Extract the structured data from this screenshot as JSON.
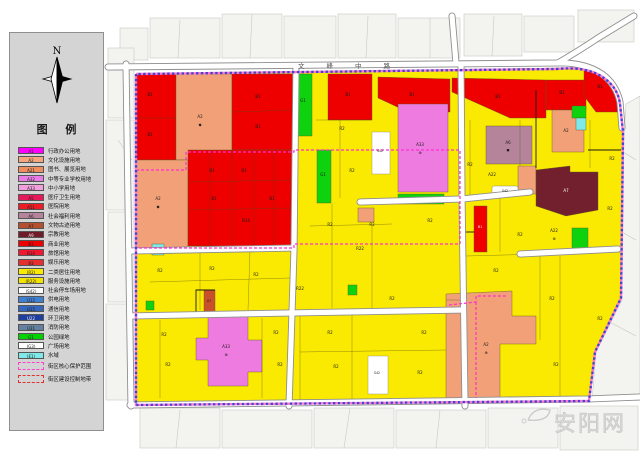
{
  "compass": {
    "label": "N"
  },
  "legend": {
    "title": "图 例",
    "items": [
      {
        "code": "A1",
        "label": "行政办公用地",
        "color": "#FF00FF"
      },
      {
        "code": "A2",
        "label": "文化设施用地",
        "color": "#F4A77C"
      },
      {
        "code": "A21",
        "label": "图书、展览用地",
        "color": "#F08D5E"
      },
      {
        "code": "A32",
        "label": "中等专业学校用地",
        "color": "#E87CE4"
      },
      {
        "code": "A33",
        "label": "中小学用地",
        "color": "#F2A0DC"
      },
      {
        "code": "A5",
        "label": "医疗卫生用地",
        "color": "#E6195A"
      },
      {
        "code": "A51",
        "label": "医院用地",
        "color": "#ED1C24"
      },
      {
        "code": "A6",
        "label": "社会福利用地",
        "color": "#B5849B"
      },
      {
        "code": "A7",
        "label": "文物古迹用地",
        "color": "#B4502F"
      },
      {
        "code": "A9",
        "label": "宗教用地",
        "color": "#701C28",
        "text": "#f0f0f0"
      },
      {
        "code": "B1",
        "label": "商业用地",
        "color": "#EE0000"
      },
      {
        "code": "B14",
        "label": "旅馆用地",
        "color": "#F01830"
      },
      {
        "code": "B3",
        "label": "娱乐用地",
        "color": "#E62E2E"
      },
      {
        "code": "(R2)",
        "label": "二类居住用地",
        "color": "#FAE900"
      },
      {
        "code": "(R22)",
        "label": "服务设施用地",
        "color": "#F2E300"
      },
      {
        "code": "(S42)",
        "label": "社会停车场用地",
        "color": "#FFFFFF"
      },
      {
        "code": "U12",
        "label": "供电用地",
        "color": "#3F7FD0"
      },
      {
        "code": "U15",
        "label": "通信用地",
        "color": "#3566BE"
      },
      {
        "code": "U22",
        "label": "环卫用地",
        "color": "#1F3F9E",
        "text": "#f0f0f0"
      },
      {
        "code": "U31",
        "label": "消防用地",
        "color": "#64819F"
      },
      {
        "code": "G1",
        "label": "公园绿地",
        "color": "#00D200"
      },
      {
        "code": "(G3)",
        "label": "广场用地",
        "color": "#FFFFFF"
      },
      {
        "code": "(E1)",
        "label": "水域",
        "color": "#7FE9EA"
      }
    ],
    "boundary_items": [
      {
        "label": "街区核心保护范围",
        "color": "#FF3FD0"
      },
      {
        "label": "街区建设控制地带",
        "color": "#E03030"
      }
    ]
  },
  "map": {
    "road_name": "文峰中路",
    "watermark": "安阳网",
    "colors": {
      "residential_yellow": "#FAE900",
      "commercial_red": "#EE0000",
      "cultural_salmon": "#F2A077",
      "school_pink": "#EE7BDF",
      "welfare_mauve": "#B5849B",
      "relics_maroon": "#72202E",
      "park_green": "#0FD20F",
      "water_cyan": "#7FE9EA",
      "parking_white": "#FFFFFF",
      "boundary_blue": "#4A3FD4",
      "boundary_pink": "#FF77C8",
      "core_pink": "#FF2FD0"
    },
    "labels": [
      {
        "t": "B1",
        "x": 150,
        "y": 96
      },
      {
        "t": "B1",
        "x": 150,
        "y": 136
      },
      {
        "t": "A2",
        "x": 200,
        "y": 118
      },
      {
        "t": "◆",
        "x": 200,
        "y": 126
      },
      {
        "t": "B1",
        "x": 258,
        "y": 98
      },
      {
        "t": "B1",
        "x": 258,
        "y": 128
      },
      {
        "t": "A2",
        "x": 158,
        "y": 200
      },
      {
        "t": "◆",
        "x": 158,
        "y": 208
      },
      {
        "t": "B1",
        "x": 212,
        "y": 172
      },
      {
        "t": "B1",
        "x": 244,
        "y": 172
      },
      {
        "t": "B1",
        "x": 214,
        "y": 200
      },
      {
        "t": "B14",
        "x": 246,
        "y": 222
      },
      {
        "t": "B1",
        "x": 272,
        "y": 200
      },
      {
        "t": "G1",
        "x": 303,
        "y": 102
      },
      {
        "t": "G1",
        "x": 323,
        "y": 176
      },
      {
        "t": "B1",
        "x": 348,
        "y": 96
      },
      {
        "t": "B1",
        "x": 412,
        "y": 96
      },
      {
        "t": "B1",
        "x": 498,
        "y": 98
      },
      {
        "t": "B1",
        "x": 562,
        "y": 94
      },
      {
        "t": "B1",
        "x": 600,
        "y": 88
      },
      {
        "t": "A2",
        "x": 566,
        "y": 132
      },
      {
        "t": "R2",
        "x": 342,
        "y": 130
      },
      {
        "t": "R2",
        "x": 352,
        "y": 172
      },
      {
        "t": "R2",
        "x": 430,
        "y": 222
      },
      {
        "t": "R2",
        "x": 470,
        "y": 166
      },
      {
        "t": "A33",
        "x": 420,
        "y": 146
      },
      {
        "t": "⊕",
        "x": 420,
        "y": 154
      },
      {
        "t": "S42",
        "x": 380,
        "y": 152,
        "s": 3.2
      },
      {
        "t": "A6",
        "x": 508,
        "y": 144
      },
      {
        "t": "■",
        "x": 508,
        "y": 151,
        "s": 3
      },
      {
        "t": "A22",
        "x": 492,
        "y": 176
      },
      {
        "t": "S42",
        "x": 505,
        "y": 192,
        "s": 3.2
      },
      {
        "t": "A7",
        "x": 566,
        "y": 192,
        "c": "#ffffff"
      },
      {
        "t": "A22",
        "x": 554,
        "y": 232
      },
      {
        "t": "⊕",
        "x": 554,
        "y": 240
      },
      {
        "t": "R2",
        "x": 612,
        "y": 160
      },
      {
        "t": "R2",
        "x": 610,
        "y": 210
      },
      {
        "t": "R2",
        "x": 600,
        "y": 320
      },
      {
        "t": "B1",
        "x": 480,
        "y": 228,
        "c": "#ffffff",
        "s": 3.2
      },
      {
        "t": "R2",
        "x": 160,
        "y": 272
      },
      {
        "t": "R2",
        "x": 212,
        "y": 270
      },
      {
        "t": "R2",
        "x": 256,
        "y": 276
      },
      {
        "t": "A7",
        "x": 209,
        "y": 302,
        "s": 3.2
      },
      {
        "t": "R2",
        "x": 164,
        "y": 336
      },
      {
        "t": "R2",
        "x": 168,
        "y": 366
      },
      {
        "t": "R2",
        "x": 276,
        "y": 334
      },
      {
        "t": "R2",
        "x": 280,
        "y": 366
      },
      {
        "t": "R2",
        "x": 330,
        "y": 334
      },
      {
        "t": "R2",
        "x": 336,
        "y": 368
      },
      {
        "t": "R2",
        "x": 392,
        "y": 300
      },
      {
        "t": "R2",
        "x": 424,
        "y": 334
      },
      {
        "t": "R2",
        "x": 420,
        "y": 374
      },
      {
        "t": "A33",
        "x": 226,
        "y": 348
      },
      {
        "t": "⊕",
        "x": 226,
        "y": 356
      },
      {
        "t": "A2",
        "x": 486,
        "y": 346
      },
      {
        "t": "⊕",
        "x": 486,
        "y": 354
      },
      {
        "t": "S42",
        "x": 377,
        "y": 374,
        "s": 3.2
      },
      {
        "t": "R2",
        "x": 496,
        "y": 272
      },
      {
        "t": "R2",
        "x": 552,
        "y": 300
      },
      {
        "t": "R2",
        "x": 556,
        "y": 366
      },
      {
        "t": "R2",
        "x": 520,
        "y": 236
      },
      {
        "t": "R22",
        "x": 300,
        "y": 290
      },
      {
        "t": "R22",
        "x": 360,
        "y": 250
      },
      {
        "t": "R2",
        "x": 372,
        "y": 226
      },
      {
        "t": "R2",
        "x": 330,
        "y": 226
      }
    ]
  }
}
